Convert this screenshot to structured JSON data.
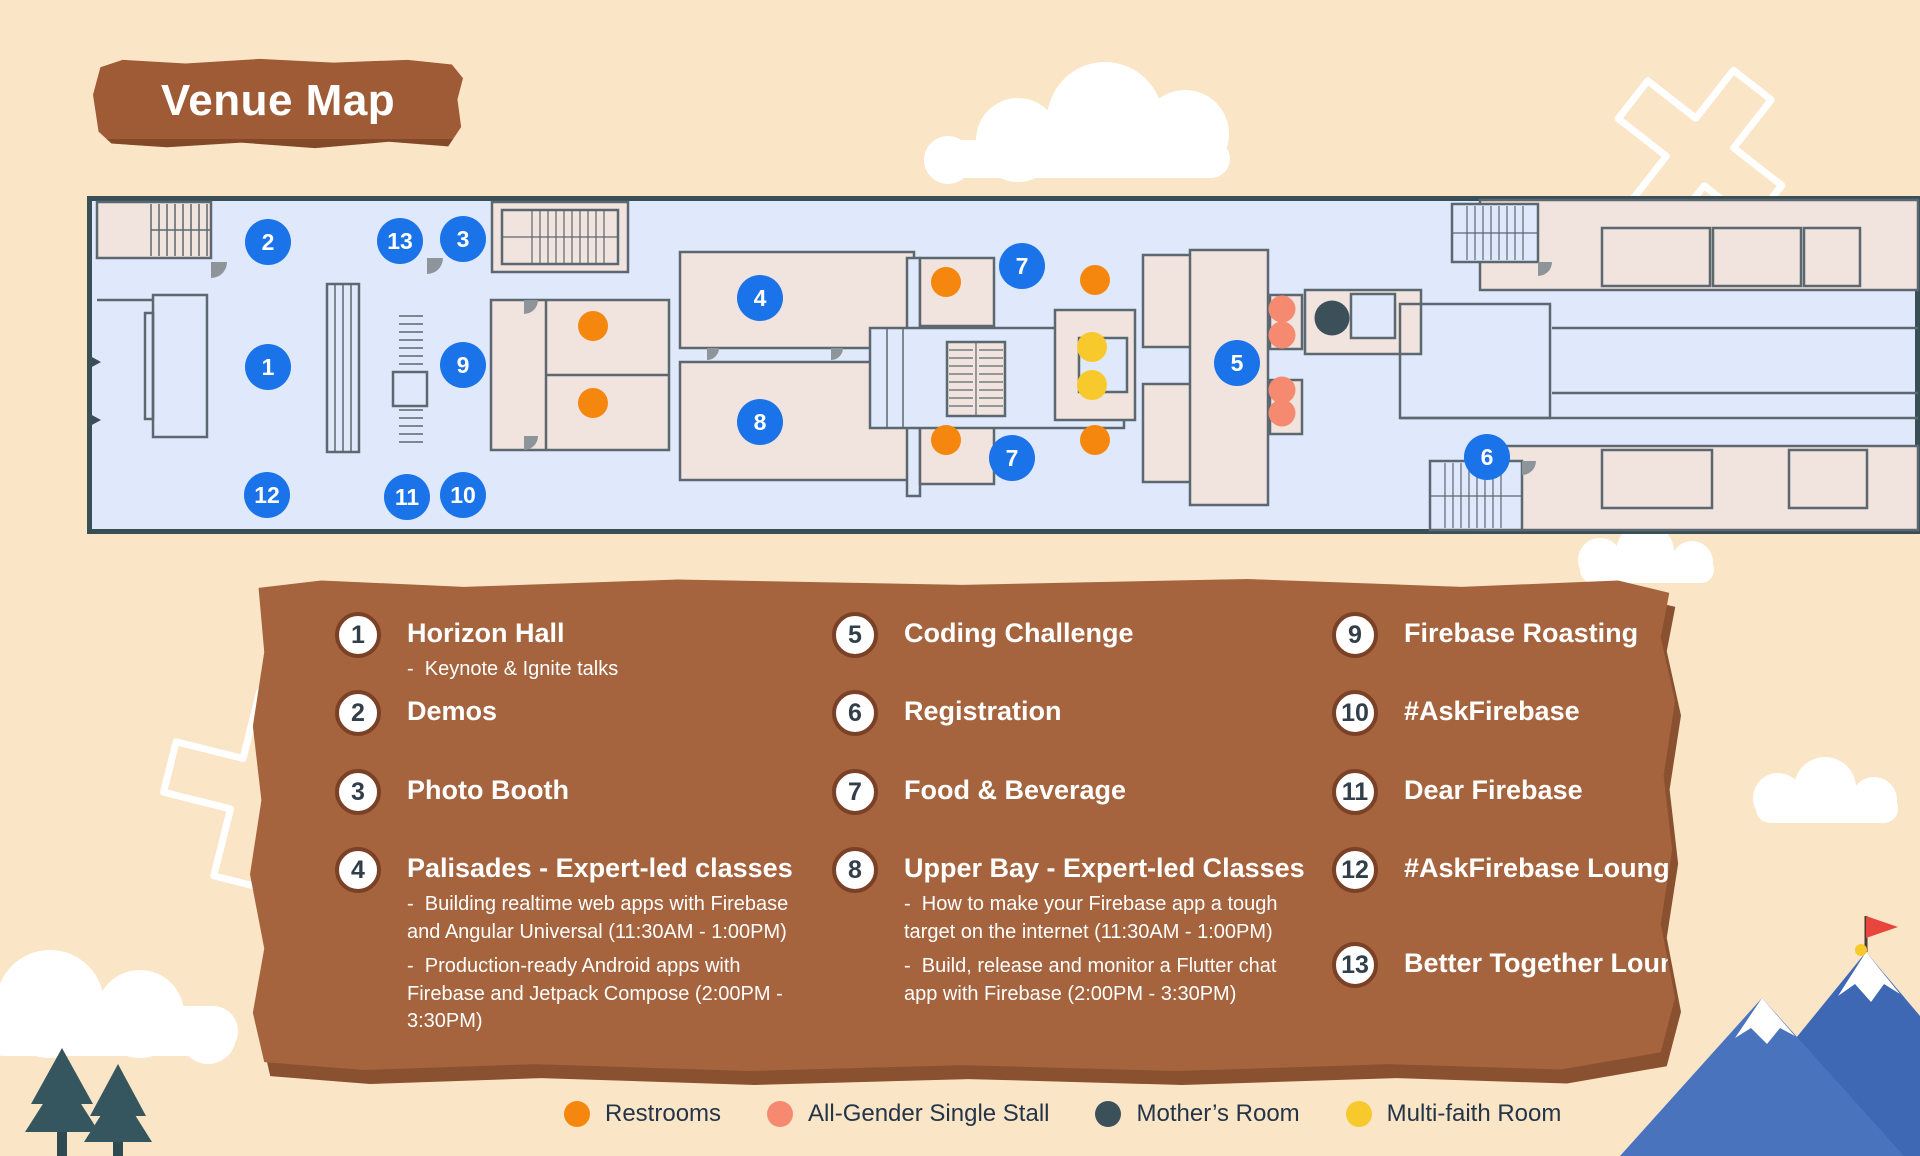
{
  "title_banner": {
    "text": "Venue Map"
  },
  "palette": {
    "background": "#FAE5C6",
    "banner_brown": "#9E5B36",
    "panel_brown": "#A5643E",
    "map_floor": "#DFE9FB",
    "map_room": "#F1E3DD",
    "map_wall": "#5C6870",
    "map_border": "#3A4E55"
  },
  "map": {
    "marker_color": "#1A73E8",
    "markers": [
      {
        "label": "2",
        "x": 268,
        "y": 242
      },
      {
        "label": "13",
        "x": 400,
        "y": 241
      },
      {
        "label": "3",
        "x": 463,
        "y": 239
      },
      {
        "label": "1",
        "x": 268,
        "y": 367
      },
      {
        "label": "9",
        "x": 463,
        "y": 365
      },
      {
        "label": "12",
        "x": 267,
        "y": 495
      },
      {
        "label": "11",
        "x": 407,
        "y": 497
      },
      {
        "label": "10",
        "x": 463,
        "y": 495
      },
      {
        "label": "4",
        "x": 760,
        "y": 298
      },
      {
        "label": "8",
        "x": 760,
        "y": 422
      },
      {
        "label": "7",
        "x": 1022,
        "y": 266
      },
      {
        "label": "7",
        "x": 1012,
        "y": 458
      },
      {
        "label": "5",
        "x": 1237,
        "y": 363
      },
      {
        "label": "6",
        "x": 1487,
        "y": 457
      }
    ],
    "facility_dots": [
      {
        "type": "restroom",
        "x": 593,
        "y": 326
      },
      {
        "type": "restroom",
        "x": 593,
        "y": 403
      },
      {
        "type": "restroom",
        "x": 946,
        "y": 282
      },
      {
        "type": "restroom",
        "x": 946,
        "y": 440
      },
      {
        "type": "restroom",
        "x": 1095,
        "y": 280
      },
      {
        "type": "restroom",
        "x": 1095,
        "y": 440
      },
      {
        "type": "multifaith",
        "x": 1092,
        "y": 347
      },
      {
        "type": "multifaith",
        "x": 1092,
        "y": 385
      },
      {
        "type": "allgender",
        "x": 1282,
        "y": 309
      },
      {
        "type": "allgender",
        "x": 1282,
        "y": 335
      },
      {
        "type": "allgender",
        "x": 1282,
        "y": 390
      },
      {
        "type": "allgender",
        "x": 1282,
        "y": 413
      },
      {
        "type": "mothers",
        "x": 1332,
        "y": 318
      }
    ]
  },
  "venue_legend": {
    "columns": [
      {
        "items": [
          {
            "number": "1",
            "title": "Horizon Hall",
            "details": [
              "-  Keynote & Ignite talks"
            ]
          },
          {
            "number": "2",
            "title": "Demos",
            "details": []
          },
          {
            "number": "3",
            "title": "Photo Booth",
            "details": []
          },
          {
            "number": "4",
            "title": "Palisades - Expert-led classes",
            "details": [
              "-  Building realtime web apps with Firebase and Angular Universal (11:30AM - 1:00PM)",
              "-  Production-ready Android apps with Firebase and Jetpack Compose (2:00PM - 3:30PM)"
            ]
          }
        ]
      },
      {
        "items": [
          {
            "number": "5",
            "title": "Coding Challenge",
            "details": []
          },
          {
            "number": "6",
            "title": "Registration",
            "details": []
          },
          {
            "number": "7",
            "title": "Food & Beverage",
            "details": []
          },
          {
            "number": "8",
            "title": "Upper Bay - Expert-led Classes",
            "details": [
              "-  How to make your Firebase app a tough target on the internet (11:30AM - 1:00PM)",
              "-  Build, release and monitor a Flutter chat app with Firebase (2:00PM - 3:30PM)"
            ]
          }
        ]
      },
      {
        "items": [
          {
            "number": "9",
            "title": "Firebase Roasting",
            "details": []
          },
          {
            "number": "10",
            "title": "#AskFirebase",
            "details": []
          },
          {
            "number": "11",
            "title": "Dear Firebase",
            "details": []
          },
          {
            "number": "12",
            "title": "#AskFirebase Lounge",
            "details": []
          },
          {
            "number": "13",
            "title": "Better Together Lounge",
            "details": []
          }
        ]
      }
    ]
  },
  "facilities_legend": {
    "items": [
      {
        "type": "restroom",
        "label": "Restrooms",
        "color": "#F5870F"
      },
      {
        "type": "allgender",
        "label": "All-Gender Single Stall",
        "color": "#F58A70"
      },
      {
        "type": "mothers",
        "label": "Mother’s Room",
        "color": "#3C5059"
      },
      {
        "type": "multifaith",
        "label": "Multi-faith Room",
        "color": "#F7C92D"
      }
    ]
  }
}
